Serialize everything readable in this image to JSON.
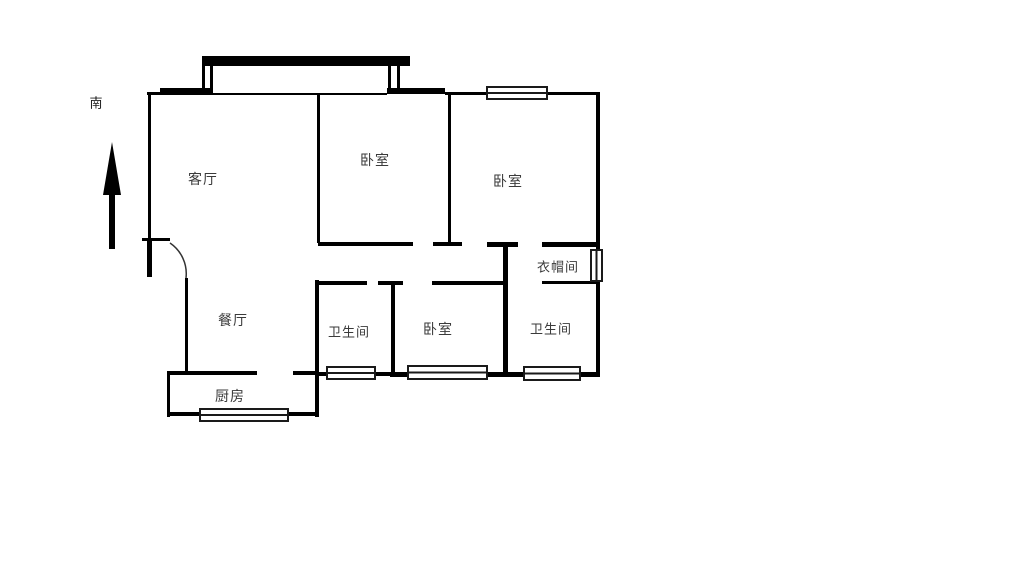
{
  "title": "apartment-floor-plan",
  "compass": {
    "label": "南"
  },
  "rooms": [
    {
      "id": "living-room",
      "label": "客厅"
    },
    {
      "id": "bedroom-top",
      "label": "卧室"
    },
    {
      "id": "bedroom-right",
      "label": "卧室"
    },
    {
      "id": "cloakroom",
      "label": "衣帽间"
    },
    {
      "id": "dining-room",
      "label": "餐厅"
    },
    {
      "id": "bathroom-left",
      "label": "卫生间"
    },
    {
      "id": "bedroom-bottom",
      "label": "卧室"
    },
    {
      "id": "bathroom-right",
      "label": "卫生间"
    },
    {
      "id": "kitchen",
      "label": "厨房"
    }
  ],
  "symbols": {
    "south-arrow": "arrow pointing up, labeled south",
    "window": "double-line rectangle on exterior wall",
    "entry-door": "arc swing at left wall"
  },
  "colors": {
    "wall": "#000000",
    "label": "#3a3a3a",
    "background": "#ffffff"
  }
}
